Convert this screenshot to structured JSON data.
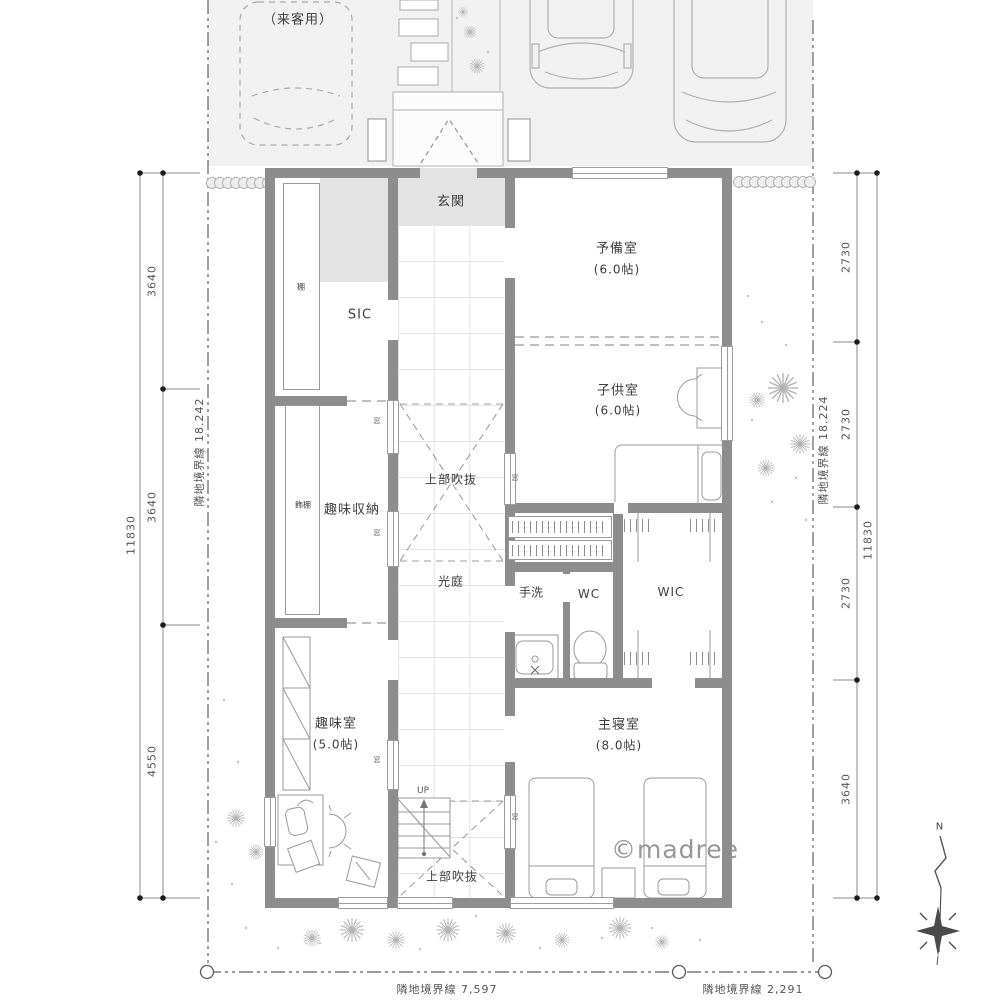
{
  "colors": {
    "wall": "#8d8d8d",
    "parking_bg": "#f1f1f1",
    "entry_floor": "#e3e3e3",
    "dim_text": "#555555",
    "label_text": "#3d3d3d",
    "watermark": "#8f8f8f"
  },
  "site": {
    "visitor_parking": "（来客用）",
    "watermark": "©madree",
    "compass_north": "N"
  },
  "rooms": {
    "entrance": "玄関",
    "sic": "SIC",
    "shelf": "棚",
    "display_shelf": "飾棚",
    "hobby_storage": "趣味収納",
    "hobby_room": "趣味室",
    "hobby_room_size": "(5.0帖)",
    "void_top": "上部吹抜",
    "light_court": "光庭",
    "spare_room": "予備室",
    "spare_room_size": "(6.0帖)",
    "kids_room": "子供室",
    "kids_room_size": "(6.0帖)",
    "hand_wash": "手洗",
    "wc": "WC",
    "wic": "WIC",
    "master_bedroom": "主寝室",
    "master_bedroom_size": "(8.0帖)",
    "void_bottom": "上部吹抜",
    "stairs_up": "UP",
    "window_tag": "窓"
  },
  "dimensions": {
    "left": {
      "total": "11830",
      "segments": [
        "3640",
        "3640",
        "4550"
      ],
      "boundary": "隣地境界線  18.242"
    },
    "right": {
      "total": "11830",
      "segments": [
        "2730",
        "2730",
        "2730",
        "3640"
      ],
      "boundary": "隣地境界線  18.224"
    },
    "bottom": {
      "front": "隣地境界線  7,597",
      "side": "隣地境界線  2,291"
    }
  }
}
